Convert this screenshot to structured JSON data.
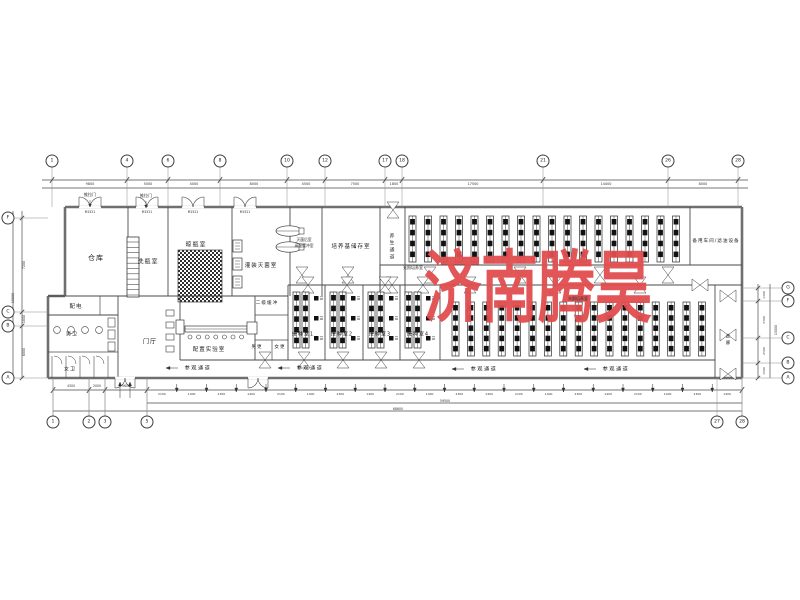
{
  "watermark": {
    "text": "济南腾昊",
    "color": "#e14e50",
    "x": 424,
    "y": 250
  },
  "rooms": [
    {
      "label": "仓库",
      "x": 96,
      "y": 258,
      "fs": 7
    },
    {
      "label": "洗瓶室",
      "x": 148,
      "y": 261,
      "fs": 6
    },
    {
      "label": "晾瓶室",
      "x": 196,
      "y": 244,
      "fs": 6
    },
    {
      "label": "灌装灭菌室",
      "x": 261,
      "y": 265,
      "fs": 5.5
    },
    {
      "label": "培养基储存室",
      "x": 351,
      "y": 246,
      "fs": 5.5
    },
    {
      "label": "备用车间/滤油设备",
      "x": 716,
      "y": 241,
      "fs": 4.6
    },
    {
      "label": "配电",
      "x": 76,
      "y": 306,
      "fs": 5.5
    },
    {
      "label": "男卫",
      "x": 72,
      "y": 334,
      "fs": 5
    },
    {
      "label": "女卫",
      "x": 70,
      "y": 369,
      "fs": 5
    },
    {
      "label": "门厅",
      "x": 150,
      "y": 341,
      "fs": 6
    },
    {
      "label": "配置实验室",
      "x": 209,
      "y": 349,
      "fs": 5.5
    },
    {
      "label": "二级缓冲",
      "x": 267,
      "y": 303,
      "fs": 4.6
    },
    {
      "label": "男更",
      "x": 257,
      "y": 347,
      "fs": 4.6
    },
    {
      "label": "女更",
      "x": 280,
      "y": 347,
      "fs": 4.6
    },
    {
      "label": "接种室1",
      "x": 303,
      "y": 334,
      "fs": 5
    },
    {
      "label": "接种室2",
      "x": 342,
      "y": 334,
      "fs": 5
    },
    {
      "label": "接种室3",
      "x": 380,
      "y": 334,
      "fs": 5
    },
    {
      "label": "接种室4",
      "x": 418,
      "y": 334,
      "fs": 5
    }
  ],
  "small_labels": [
    {
      "label": "推拉门",
      "x": 90,
      "y": 195,
      "fs": 4
    },
    {
      "label": "推拉门",
      "x": 146,
      "y": 196,
      "fs": 4
    },
    {
      "label": "灭菌后室",
      "x": 304,
      "y": 240,
      "fs": 3.8
    },
    {
      "label": "高温缓冲室",
      "x": 304,
      "y": 246,
      "fs": 3.8
    },
    {
      "label": "光照培养室",
      "x": 413,
      "y": 268,
      "fs": 4
    },
    {
      "label": "光照培养室",
      "x": 578,
      "y": 299,
      "fs": 4
    },
    {
      "label": "M1521",
      "x": 90,
      "y": 212,
      "fs": 3.1
    },
    {
      "label": "M1521",
      "x": 147,
      "y": 212,
      "fs": 3.1
    },
    {
      "label": "M1521",
      "x": 193,
      "y": 212,
      "fs": 3.1
    },
    {
      "label": "M1521",
      "x": 245,
      "y": 212,
      "fs": 3.1
    }
  ],
  "vertical_labels": [
    {
      "label": "养生通道",
      "x": 392,
      "y": 247,
      "fs": 5
    },
    {
      "label": "走廊",
      "x": 727,
      "y": 340,
      "fs": 4.6
    }
  ],
  "corridor_labels": [
    {
      "label": "参观通道",
      "x": 198,
      "y": 368
    },
    {
      "label": "参观通道",
      "x": 310,
      "y": 368
    },
    {
      "label": "参观通道",
      "x": 484,
      "y": 369
    },
    {
      "label": "参观通道",
      "x": 616,
      "y": 369
    }
  ],
  "grid": {
    "top": [
      {
        "n": "1",
        "x": 52
      },
      {
        "n": "4",
        "x": 127
      },
      {
        "n": "6",
        "x": 168
      },
      {
        "n": "8",
        "x": 220
      },
      {
        "n": "10",
        "x": 287
      },
      {
        "n": "12",
        "x": 325
      },
      {
        "n": "17",
        "x": 385
      },
      {
        "n": "18",
        "x": 402
      },
      {
        "n": "21",
        "x": 543
      },
      {
        "n": "26",
        "x": 668
      },
      {
        "n": "28",
        "x": 738
      }
    ],
    "bottom": [
      {
        "n": "1",
        "x": 53
      },
      {
        "n": "2",
        "x": 89
      },
      {
        "n": "3",
        "x": 105
      },
      {
        "n": "5",
        "x": 147
      },
      {
        "n": "27",
        "x": 717
      },
      {
        "n": "28",
        "x": 742
      }
    ],
    "left": [
      {
        "n": "F",
        "y": 218
      },
      {
        "n": "C",
        "y": 312
      },
      {
        "n": "B",
        "y": 326
      },
      {
        "n": "A",
        "y": 378
      }
    ],
    "right": [
      {
        "n": "G",
        "y": 288
      },
      {
        "n": "F",
        "y": 301
      },
      {
        "n": "C",
        "y": 338
      },
      {
        "n": "B",
        "y": 363
      },
      {
        "n": "A",
        "y": 378
      }
    ]
  },
  "dimensions": {
    "top": [
      {
        "v": "9800",
        "x": 90
      },
      {
        "v": "5000",
        "x": 148
      },
      {
        "v": "4000",
        "x": 194
      },
      {
        "v": "8000",
        "x": 254
      },
      {
        "v": "4500",
        "x": 306
      },
      {
        "v": "7500",
        "x": 355
      },
      {
        "v": "1800",
        "x": 394
      },
      {
        "v": "17500",
        "x": 473
      },
      {
        "v": "14400",
        "x": 606
      },
      {
        "v": "8000",
        "x": 703
      }
    ],
    "bottom_first": [
      {
        "v": "4300",
        "x": 71
      },
      {
        "v": "2000",
        "x": 97
      },
      {
        "v": "5600",
        "x": 126
      }
    ],
    "bottom_chain": [
      "2100",
      "1400",
      "2300",
      "1400",
      "2100",
      "1400",
      "2300",
      "1400",
      "2100",
      "1400",
      "2300",
      "1400",
      "2100",
      "1400",
      "2300",
      "1400",
      "2100",
      "1400",
      "2300",
      "1400"
    ],
    "bottom_totals": [
      {
        "v": "59500",
        "x": 445,
        "y": 401
      },
      {
        "v": "68600",
        "x": 398,
        "y": 409
      }
    ],
    "left": [
      {
        "v": "7200",
        "y": 265
      },
      {
        "v": "1800",
        "y": 319
      },
      {
        "v": "6000",
        "y": 352
      }
    ],
    "left_total": "15000",
    "right": [
      {
        "v": "1300",
        "y": 295
      },
      {
        "v": "3700",
        "y": 320
      },
      {
        "v": "2500",
        "y": 351
      },
      {
        "v": "1500",
        "y": 371
      }
    ],
    "right_total": "15000"
  }
}
